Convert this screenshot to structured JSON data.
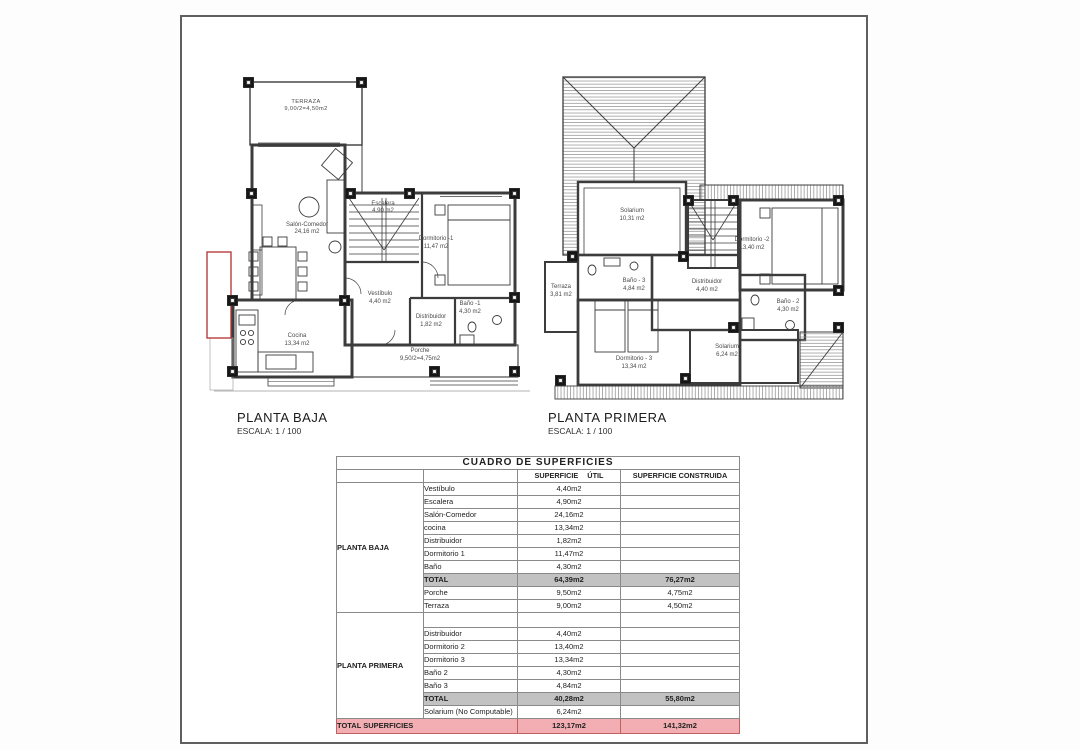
{
  "sheet": {
    "plans": [
      {
        "title": "PLANTA BAJA",
        "scale": "ESCALA: 1 / 100",
        "rooms": {
          "terraza": {
            "name": "TERRAZA",
            "area": "9,00/2=4,50m2"
          },
          "salon": {
            "name": "Salón-Comedor",
            "area": "24,16 m2"
          },
          "escalera": {
            "name": "Escalera",
            "area": "4,90 m2"
          },
          "dormitorio1": {
            "name": "Dormitorio -1",
            "area": "11,47 m2"
          },
          "vestibulo": {
            "name": "Vestíbulo",
            "area": "4,40 m2"
          },
          "distribuidor": {
            "name": "Distribuidor",
            "area": "1,82 m2"
          },
          "bano1": {
            "name": "Baño -1",
            "area": "4,30 m2"
          },
          "cocina": {
            "name": "Cocina",
            "area": "13,34 m2"
          },
          "porche": {
            "name": "Porche",
            "area": "9,50/2=4,75m2"
          }
        }
      },
      {
        "title": "PLANTA PRIMERA",
        "scale": "ESCALA: 1 / 100",
        "rooms": {
          "solarium_sup": {
            "name": "Solarium",
            "area": "10,31 m2"
          },
          "dormitorio2": {
            "name": "Dormitorio -2",
            "area": "13,40 m2"
          },
          "terraza": {
            "name": "Terraza",
            "area": "3,81 m2"
          },
          "bano3": {
            "name": "Baño - 3",
            "area": "4,84 m2"
          },
          "distribuidor": {
            "name": "Distribuidor",
            "area": "4,40 m2"
          },
          "bano2": {
            "name": "Baño - 2",
            "area": "4,30 m2"
          },
          "dormitorio3": {
            "name": "Dormitorio - 3",
            "area": "13,34 m2"
          },
          "solarium_inf": {
            "name": "Solarium",
            "area": "6,24 m2"
          }
        }
      }
    ]
  },
  "table": {
    "title": "CUADRO DE SUPERFICIES",
    "col_util": "SUPERFICIE ÚTIL",
    "col_construida": "SUPERFICIE CONSTRUIDA",
    "groups": [
      {
        "label": "PLANTA BAJA",
        "rows": [
          {
            "name": "Vestíbulo",
            "util": "4,40m2",
            "cons": ""
          },
          {
            "name": "Escalera",
            "util": "4,90m2",
            "cons": ""
          },
          {
            "name": "Salón-Comedor",
            "util": "24,16m2",
            "cons": ""
          },
          {
            "name": "cocina",
            "util": "13,34m2",
            "cons": ""
          },
          {
            "name": "Distribuidor",
            "util": "1,82m2",
            "cons": ""
          },
          {
            "name": "Dormitorio 1",
            "util": "11,47m2",
            "cons": ""
          },
          {
            "name": "Baño",
            "util": "4,30m2",
            "cons": ""
          },
          {
            "name": "TOTAL",
            "util": "64,39m2",
            "cons": "76,27m2"
          },
          {
            "name": "Porche",
            "util": "9,50m2",
            "cons": "4,75m2"
          },
          {
            "name": "Terraza",
            "util": "9,00m2",
            "cons": "4,50m2"
          }
        ]
      },
      {
        "label": "PLANTA PRIMERA",
        "rows": [
          {
            "name": "",
            "util": "",
            "cons": ""
          },
          {
            "name": "Distribuidor",
            "util": "4,40m2",
            "cons": ""
          },
          {
            "name": "Dormitorio 2",
            "util": "13,40m2",
            "cons": ""
          },
          {
            "name": "Dormitorio 3",
            "util": "13,34m2",
            "cons": ""
          },
          {
            "name": "Baño 2",
            "util": "4,30m2",
            "cons": ""
          },
          {
            "name": "Baño 3",
            "util": "4,84m2",
            "cons": ""
          },
          {
            "name": "TOTAL",
            "util": "40,28m2",
            "cons": "55,80m2"
          },
          {
            "name": "Solarium (No Computable)",
            "util": "6,24m2",
            "cons": ""
          }
        ]
      }
    ],
    "footer": {
      "label": "TOTAL SUPERFICIES",
      "util": "123,17m2",
      "cons": "141,32m2"
    }
  },
  "colors": {
    "table_header": "#c8c5e2",
    "total_row": "#c2c2c2",
    "footer_row": "#f2aeb2",
    "red_outline": "#b03030",
    "wall": "#3c3c3c"
  }
}
